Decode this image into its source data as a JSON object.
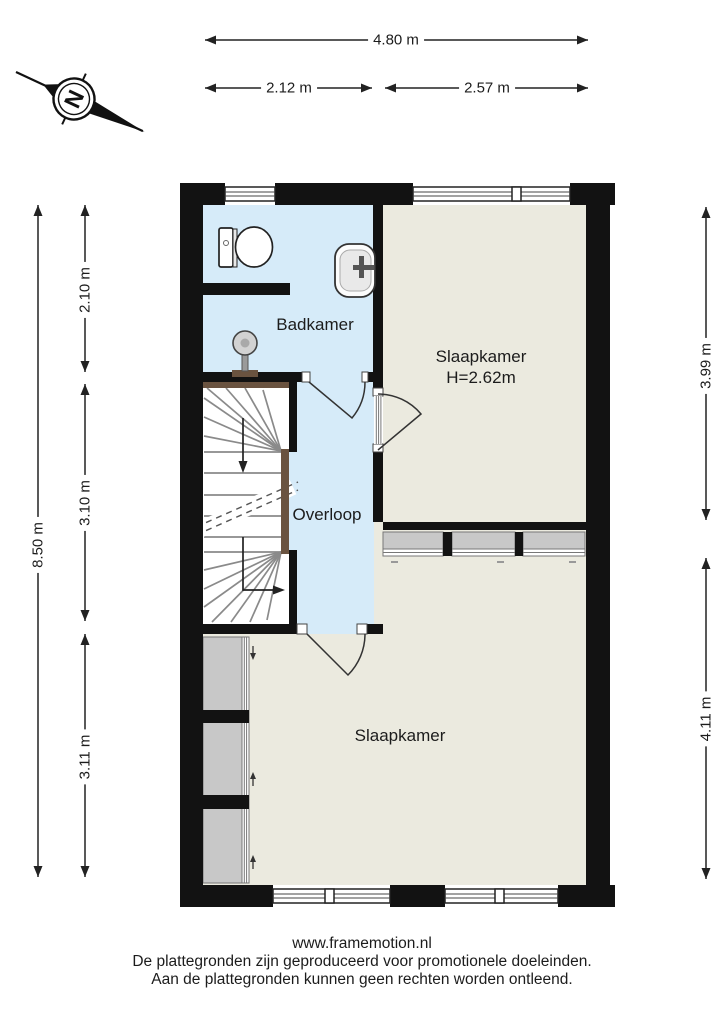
{
  "colors": {
    "wall": "#121212",
    "wet_floor": "#d6ebf9",
    "dry_floor": "#ebeadf",
    "closet": "#c8c8c8",
    "wood": "#6a5340",
    "line": "#222222"
  },
  "compass": {
    "letter": "N"
  },
  "dimensions": {
    "width_total": "4.80 m",
    "width_left": "2.12 m",
    "width_right": "2.57 m",
    "height_total": "8.50 m",
    "height_top": "2.10 m",
    "height_mid": "3.10 m",
    "height_bottom": "3.11 m",
    "right_top": "3.99 m",
    "right_bottom": "4.11 m"
  },
  "rooms": {
    "bathroom": {
      "label": "Badkamer"
    },
    "bedroom_top": {
      "label": "Slaapkamer",
      "height_note": "H=2.62m"
    },
    "landing": {
      "label": "Overloop"
    },
    "bedroom_bottom": {
      "label": "Slaapkamer"
    }
  },
  "footer": {
    "website": "www.framemotion.nl",
    "line1": "De plattegronden zijn geproduceerd voor promotionele doeleinden.",
    "line2": "Aan de plattegronden kunnen geen rechten worden ontleend."
  }
}
